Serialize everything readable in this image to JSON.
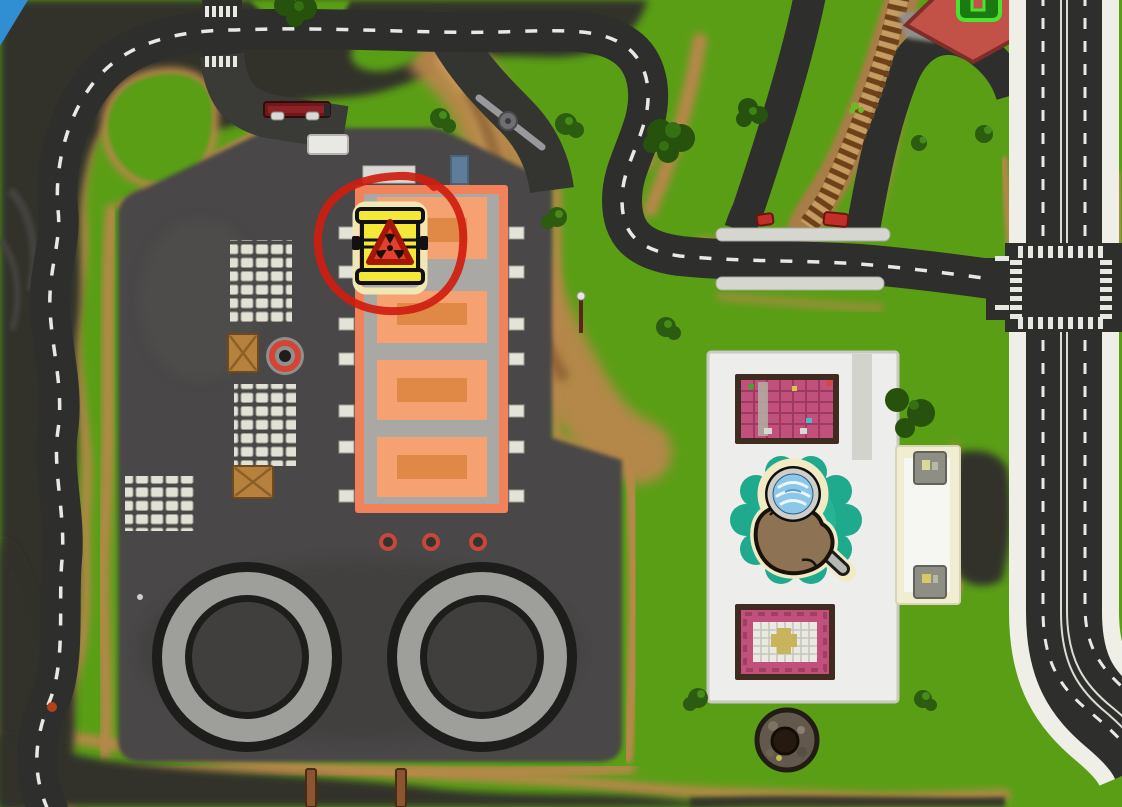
{
  "scene": {
    "title": "top-down-game-world-map",
    "description": "Aerial game map view: industrial depot with warehouse and fuel tanks on the left, shop building with detective search marker on the right, winding roads, dead-end rail spur, and a hazardous barrel map marker circled in red"
  },
  "annotation": {
    "type": "hand-drawn-circle",
    "color": "#cf1d10",
    "target": "hazard-barrel-marker"
  },
  "markers": {
    "hazard_barrel": {
      "name": "hazardous-waste-barrel",
      "barrel_color": "#f4e838",
      "warning_triangle_color": "#e2402c",
      "symbol": "radioactive-trefoil"
    },
    "detective_spot": {
      "name": "magnifying-glass-search-spot",
      "ring_color": "#1fa98d",
      "lens_color": "#8cc6e9",
      "paw_color": "#8d7253"
    }
  },
  "map": {
    "colors": {
      "grass": "#5a9e16",
      "dirt": "#b8874c",
      "rock": "#30302c",
      "road": "#2e2e2c",
      "road_line": "#e8e8e4",
      "sidewalk": "#efefe7",
      "platform": "#484746",
      "warehouse_trim": "#f2825a",
      "warehouse_bay": "#f5a171",
      "store_pink": "#c1507c",
      "rail_tie": "#6e4119",
      "water": "#2f8fd2"
    },
    "features": {
      "fuel_tanks": 2,
      "warehouse_bays": 4,
      "store_rooms": 2,
      "pallet_clusters": 3,
      "crates": 2,
      "rail_spur": "dead-end-with-red-buffer-stops",
      "railroad_crossing_bars": 2,
      "vehicles": [
        "red-truck",
        "white-van"
      ],
      "well": 1,
      "intersection": "four-way-with-crosswalks",
      "gate_barrier": 1
    }
  }
}
